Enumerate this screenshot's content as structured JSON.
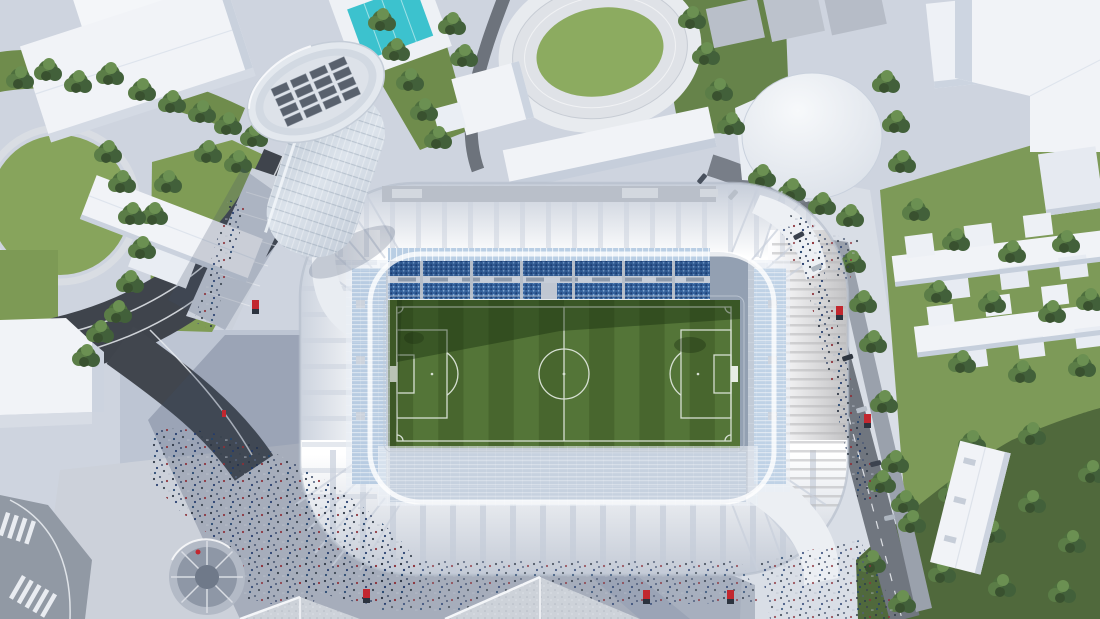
{
  "scene": {
    "type": "aerial-architectural-rendering",
    "subject": "football-stadium-with-glass-tower",
    "setting": "urban-district-with-park-pool-running-track-and-residential-blocks",
    "lighting": "daylight-sun-from-upper-right"
  },
  "colors": {
    "ground": "#ced4df",
    "plaza_shadowed": "#bdc5d3",
    "plaza_bright": "#d9dee6",
    "asphalt_dark": "#3f444c",
    "street_gray": "#70767f",
    "corner_street": "#9199a4",
    "parking_strip": "#9aa1ac",
    "roof_white": "#eff1f5",
    "roof_shade": "#c7ced9",
    "membrane_rib": "#c9d0dc",
    "glass_band": "#b9cee4",
    "stand_blue": "#34619b",
    "stand_west": "#7ca3c9",
    "stand_east": "#8db0d2",
    "stand_south": "#92a6bd",
    "pitch_light": "#547538",
    "pitch_dark": "#48662e",
    "pitch_line": "#d6dfd2",
    "pitch_shadow": "#152b0d",
    "pool_water": "#3cc2ce",
    "lawn": "#87a45c",
    "infield": "#8cab60",
    "park_green": "#6f8c4c",
    "park_dark": "#50693c",
    "tree_dark": "#42603a",
    "tree_mid": "#4e6f3e",
    "tree_light": "#6b9052",
    "building_white": "#f1f3f7",
    "building_shade": "#ccd3df",
    "cylinder_white": "#f1f4f8",
    "gravel_roof": "#cdd2d9",
    "accent_red": "#c2272f",
    "crowd_dark": "#2b3442",
    "shadow_cast": "#3e4c68"
  },
  "stadium": {
    "pitch": {
      "stripes": 14,
      "markings": [
        "touchlines",
        "halfway-line",
        "centre-circle",
        "penalty-areas",
        "goal-areas",
        "penalty-arcs",
        "corner-arcs",
        "penalty-spots",
        "goals"
      ]
    },
    "stands": [
      "north-main-blue",
      "west-light-blue",
      "east-light-blue",
      "south-covered"
    ],
    "roof": "white-ribbed-membrane-ring-with-translucent-inner-cable-net",
    "tower": {
      "shape": "leaning-elliptical-glass-tower",
      "rooftop_unit_rows": 4,
      "rooftop_units_per_row": 4
    }
  },
  "landmarks": [
    "glass-tower",
    "swimming-pool",
    "running-track",
    "cylindrical-hall",
    "residential-cross-blocks",
    "spiral-ramp",
    "plaza-crowds",
    "tree-lined-streets",
    "zebra-crossings"
  ]
}
